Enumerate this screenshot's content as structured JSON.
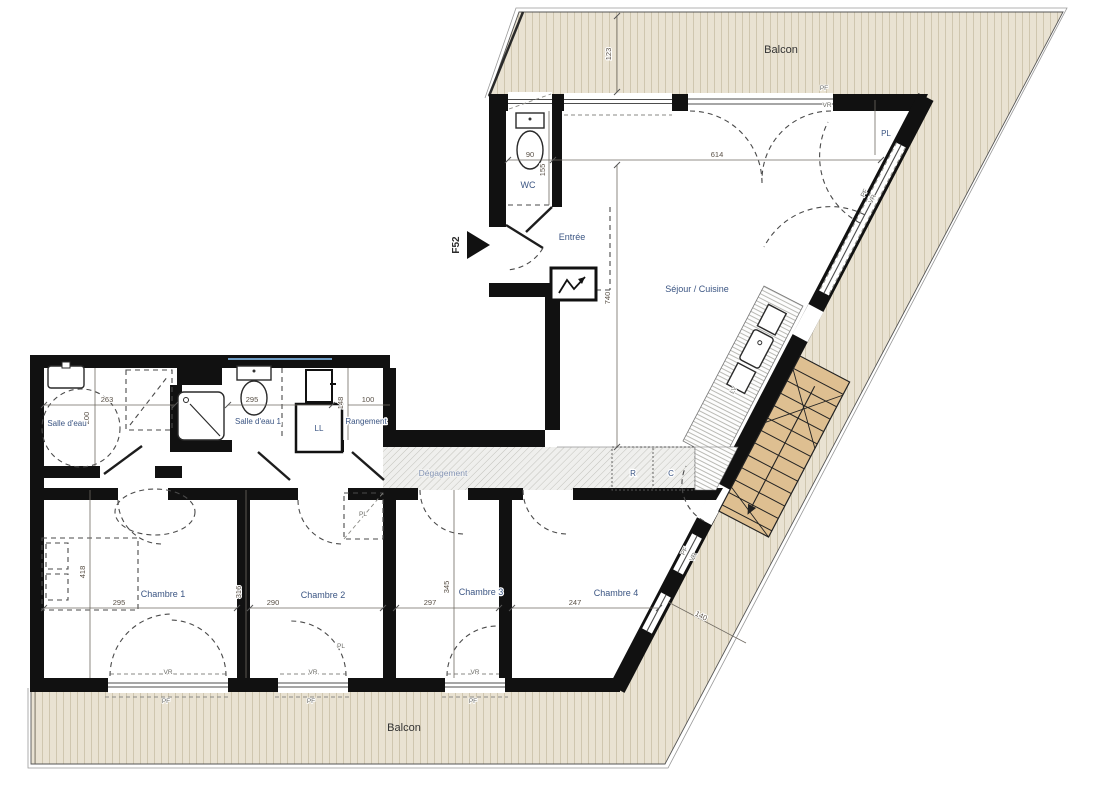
{
  "unit": {
    "id": "F52"
  },
  "labels": {
    "balcon": "Balcon",
    "wc": "WC",
    "entree": "Entrée",
    "sejour_cuisine": "Séjour / Cuisine",
    "salle_deau": "Salle d'eau",
    "salle_deau_1": "Salle d'eau 1",
    "rangement": "Rangement",
    "degagement": "Dégagement",
    "chambre_1": "Chambre 1",
    "chambre_2": "Chambre 2",
    "chambre_3": "Chambre 3",
    "chambre_4": "Chambre 4",
    "ll": "LL",
    "lv": "LV",
    "r": "R",
    "c": "C",
    "pl": "PL",
    "pf": "PF",
    "vr": "VR"
  },
  "dims": {
    "top_balcony_depth": "123",
    "wc_width": "90",
    "wc_height": "155",
    "sejour_width": "614",
    "sejour_height": "740",
    "salle_deau_width": "263",
    "salle_deau_height": "200",
    "salle_deau_1_width": "295",
    "rangement_height": "148",
    "rangement_width": "100",
    "chambre_1_height": "418",
    "chambre_1_width": "295",
    "chambre_2_height": "316",
    "chambre_2_width": "290",
    "chambre_3_height": "345",
    "chambre_3_width": "297",
    "chambre_4_width": "247",
    "side_balcony_width": "140"
  },
  "colors": {
    "wall": "#111111",
    "deck": "#e9e2d2",
    "deck_stripe": "#cfc6af",
    "stairs": "#debf91",
    "room_label": "#3b5583",
    "dimension_text": "#5a5147",
    "hall_label": "#8595b5",
    "high_window": "#6d9bc3"
  }
}
